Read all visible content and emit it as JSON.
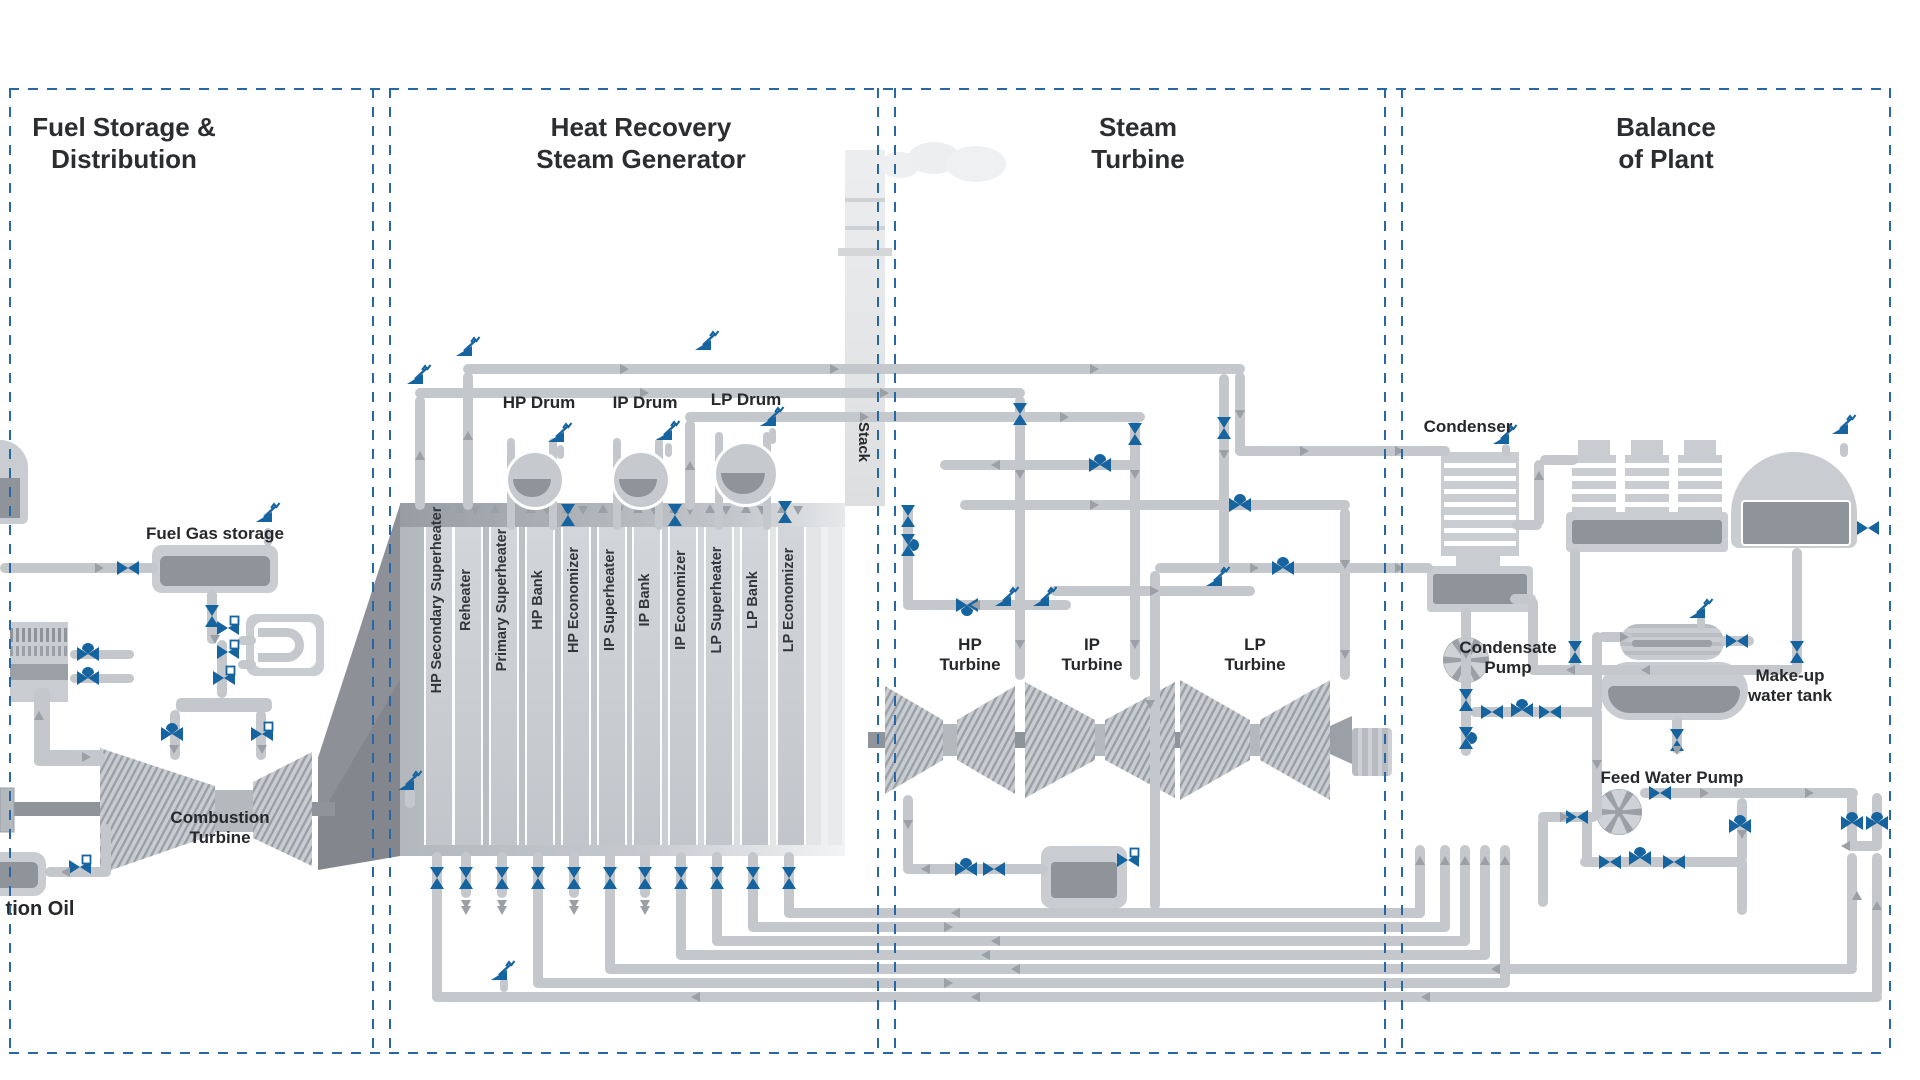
{
  "sections": [
    {
      "name": "fuel-storage",
      "label": "Fuel Storage &\nDistribution"
    },
    {
      "name": "hrsg",
      "label": "Heat Recovery\nSteam Generator"
    },
    {
      "name": "steam-turbine",
      "label": "Steam\nTurbine"
    },
    {
      "name": "balance-of-plant",
      "label": "Balance\nof Plant"
    }
  ],
  "colors": {
    "valve_blue": "#15639f",
    "dash_blue": "#2767a5",
    "pipe_gray": "#c4c8cc",
    "arrow_gray": "#9aa0a6",
    "equip_light": "#c9cdd2",
    "equip_dark": "#8f949a",
    "ink": "#2b2d31"
  },
  "borders": {
    "verticals": [
      9,
      372,
      389,
      877,
      894,
      1384,
      1401,
      1889
    ],
    "top": 88,
    "bottom": 1052
  },
  "hrsg_columns": [
    {
      "label": "HP Secondary Superheater",
      "x": 437,
      "run": 997
    },
    {
      "label": "Reheater",
      "x": 466
    },
    {
      "label": "Primary Superheater",
      "x": 502
    },
    {
      "label": "HP Bank",
      "x": 538,
      "run": 983
    },
    {
      "label": "HP Economizer",
      "x": 574
    },
    {
      "label": "IP Superheater",
      "x": 610,
      "run": 969
    },
    {
      "label": "IP Bank",
      "x": 645
    },
    {
      "label": "IP Economizer",
      "x": 681,
      "run": 955
    },
    {
      "label": "LP Superheater",
      "x": 717,
      "run": 941
    },
    {
      "label": "LP Bank",
      "x": 753,
      "run": 927
    },
    {
      "label": "LP Economizer",
      "x": 789,
      "run": 913
    }
  ],
  "drums": [
    {
      "name": "hp-drum",
      "x": 532,
      "y": 477,
      "r": 27
    },
    {
      "name": "ip-drum",
      "x": 638,
      "y": 477,
      "r": 27
    },
    {
      "name": "lp-drum",
      "x": 743,
      "y": 471,
      "r": 30
    }
  ],
  "labels": [
    {
      "name": "hp-drum-label",
      "text": "HP Drum",
      "x": 539,
      "y": 403
    },
    {
      "name": "ip-drum-label",
      "text": "IP Drum",
      "x": 645,
      "y": 403
    },
    {
      "name": "lp-drum-label",
      "text": "LP Drum",
      "x": 746,
      "y": 400
    },
    {
      "name": "stack-label",
      "text": "Stack",
      "x": 863,
      "y": 442,
      "rot": 90,
      "size": 15
    },
    {
      "name": "hp-turbine-label",
      "text": "HP\nTurbine",
      "x": 970,
      "y": 655
    },
    {
      "name": "ip-turbine-label",
      "text": "IP\nTurbine",
      "x": 1092,
      "y": 655
    },
    {
      "name": "lp-turbine-label",
      "text": "LP\nTurbine",
      "x": 1255,
      "y": 655
    },
    {
      "name": "combustion-turbine-label",
      "text": "Combustion\nTurbine",
      "x": 220,
      "y": 828
    },
    {
      "name": "fuel-gas-storage-label",
      "text": "Fuel Gas storage",
      "x": 215,
      "y": 534
    },
    {
      "name": "oil-label",
      "text": "tion Oil",
      "x": 40,
      "y": 910,
      "size": 20
    },
    {
      "name": "condenser-label",
      "text": "Condenser",
      "x": 1468,
      "y": 427
    },
    {
      "name": "condensate-pump-label",
      "text": "Condensate\nPump",
      "x": 1508,
      "y": 658
    },
    {
      "name": "makeup-water-tank-label",
      "text": "Make-up\nwater tank",
      "x": 1790,
      "y": 686
    },
    {
      "name": "feed-water-pump-label",
      "text": "Feed Water Pump",
      "x": 1672,
      "y": 778
    }
  ],
  "pipes": [
    [
      0,
      563,
      158,
      10
    ],
    [
      207,
      590,
      10,
      54
    ],
    [
      176,
      698,
      96,
      14
    ],
    [
      170,
      710,
      10,
      50
    ],
    [
      256,
      710,
      10,
      50
    ],
    [
      70,
      650,
      64,
      9
    ],
    [
      70,
      674,
      64,
      9
    ],
    [
      34,
      688,
      16,
      76
    ],
    [
      34,
      750,
      70,
      16
    ],
    [
      45,
      867,
      64,
      10
    ],
    [
      101,
      824,
      10,
      53
    ],
    [
      238,
      636,
      18,
      9
    ],
    [
      238,
      660,
      18,
      9
    ],
    [
      217,
      640,
      10,
      58
    ],
    [
      415,
      388,
      610,
      10
    ],
    [
      415,
      396,
      10,
      114
    ],
    [
      1015,
      396,
      10,
      284
    ],
    [
      463,
      364,
      782,
      10
    ],
    [
      463,
      372,
      10,
      138
    ],
    [
      1235,
      372,
      10,
      84
    ],
    [
      1235,
      446,
      215,
      10
    ],
    [
      685,
      412,
      460,
      10
    ],
    [
      685,
      420,
      10,
      90
    ],
    [
      1130,
      420,
      10,
      260
    ],
    [
      960,
      500,
      390,
      10
    ],
    [
      1340,
      508,
      10,
      172
    ],
    [
      940,
      460,
      200,
      10
    ],
    [
      903,
      505,
      10,
      102
    ],
    [
      903,
      600,
      168,
      10
    ],
    [
      1050,
      586,
      205,
      10
    ],
    [
      1219,
      374,
      10,
      196
    ],
    [
      1155,
      563,
      278,
      10
    ],
    [
      1150,
      571,
      10,
      339
    ],
    [
      507,
      438,
      8,
      92
    ],
    [
      549,
      438,
      8,
      92
    ],
    [
      613,
      438,
      8,
      92
    ],
    [
      655,
      438,
      8,
      92
    ],
    [
      715,
      432,
      8,
      98
    ],
    [
      763,
      432,
      8,
      98
    ],
    [
      557,
      445,
      7,
      14
    ],
    [
      665,
      443,
      7,
      14
    ],
    [
      769,
      428,
      7,
      16
    ],
    [
      405,
      788,
      10,
      20
    ],
    [
      903,
      795,
      10,
      76
    ],
    [
      903,
      864,
      145,
      10
    ],
    [
      1512,
      520,
      30,
      10
    ],
    [
      1534,
      460,
      10,
      66
    ],
    [
      1540,
      455,
      38,
      10
    ],
    [
      1570,
      548,
      10,
      124
    ],
    [
      1792,
      548,
      10,
      124
    ],
    [
      1528,
      598,
      10,
      74
    ],
    [
      1510,
      594,
      26,
      10
    ],
    [
      1528,
      665,
      274,
      10
    ],
    [
      1461,
      608,
      10,
      148
    ],
    [
      1470,
      707,
      130,
      10
    ],
    [
      1592,
      632,
      10,
      80
    ],
    [
      1598,
      632,
      34,
      10
    ],
    [
      1592,
      707,
      10,
      112
    ],
    [
      1538,
      812,
      60,
      10
    ],
    [
      1538,
      817,
      10,
      90
    ],
    [
      1720,
      636,
      34,
      10
    ],
    [
      1672,
      716,
      10,
      38
    ],
    [
      1640,
      788,
      218,
      10
    ],
    [
      1737,
      798,
      10,
      64
    ],
    [
      1582,
      817,
      10,
      44
    ],
    [
      1580,
      857,
      164,
      10
    ],
    [
      1737,
      857,
      10,
      58
    ],
    [
      1847,
      793,
      10,
      55
    ],
    [
      1872,
      793,
      10,
      55
    ],
    [
      1847,
      841,
      35,
      10
    ],
    [
      1847,
      853,
      10,
      116
    ],
    [
      1872,
      853,
      10,
      144
    ],
    [
      784,
      908,
      641,
      10
    ],
    [
      748,
      922,
      702,
      10
    ],
    [
      712,
      936,
      758,
      10
    ],
    [
      676,
      950,
      814,
      10
    ],
    [
      605,
      964,
      1252,
      10
    ],
    [
      534,
      978,
      976,
      10
    ],
    [
      432,
      992,
      1450,
      10
    ],
    [
      1415,
      845,
      10,
      73
    ],
    [
      1440,
      845,
      10,
      87
    ],
    [
      1460,
      845,
      10,
      101
    ],
    [
      1480,
      845,
      10,
      115
    ],
    [
      1500,
      845,
      10,
      143
    ],
    [
      264,
      528,
      8,
      18
    ],
    [
      1840,
      443,
      8,
      14
    ],
    [
      1697,
      616,
      8,
      14
    ],
    [
      1502,
      444,
      8,
      12
    ],
    [
      500,
      978,
      8,
      14
    ]
  ],
  "valves": [
    [
      "gate",
      128,
      568,
      0
    ],
    [
      "gate",
      994,
      869,
      0
    ],
    [
      "gate",
      1492,
      712,
      0
    ],
    [
      "gate",
      1550,
      712,
      0
    ],
    [
      "gate",
      1577,
      817,
      0
    ],
    [
      "gate",
      1660,
      793,
      0
    ],
    [
      "gate",
      1610,
      862,
      0
    ],
    [
      "gate",
      1674,
      862,
      0
    ],
    [
      "gate",
      1868,
      528,
      0
    ],
    [
      "gate",
      1737,
      641,
      0
    ],
    [
      "gate",
      212,
      616,
      90
    ],
    [
      "gate",
      568,
      515,
      90
    ],
    [
      "gate",
      675,
      515,
      90
    ],
    [
      "gate",
      785,
      512,
      90
    ],
    [
      "gate",
      908,
      516,
      90
    ],
    [
      "gate",
      1020,
      414,
      90
    ],
    [
      "gate",
      1135,
      434,
      90
    ],
    [
      "gate",
      1224,
      428,
      90
    ],
    [
      "gate",
      1466,
      700,
      90
    ],
    [
      "gate",
      1575,
      652,
      90
    ],
    [
      "gate",
      1797,
      652,
      90
    ],
    [
      "gate",
      1677,
      740,
      90
    ],
    [
      "globe",
      88,
      654,
      0
    ],
    [
      "globe",
      88,
      678,
      0
    ],
    [
      "globe",
      966,
      869,
      0
    ],
    [
      "globe",
      1100,
      465,
      0
    ],
    [
      "globe",
      1240,
      505,
      0
    ],
    [
      "globe",
      1522,
      710,
      0
    ],
    [
      "globe",
      1640,
      858,
      0
    ],
    [
      "globe",
      1740,
      826,
      0
    ],
    [
      "globe",
      1852,
      823,
      0
    ],
    [
      "globe",
      1877,
      823,
      0
    ],
    [
      "globe",
      967,
      605,
      180
    ],
    [
      "globe",
      908,
      545,
      90
    ],
    [
      "globe",
      1466,
      738,
      90
    ],
    [
      "globe",
      1283,
      568,
      0
    ],
    [
      "check",
      80,
      867,
      0
    ],
    [
      "check",
      228,
      628,
      0
    ],
    [
      "check",
      228,
      652,
      0
    ],
    [
      "check",
      224,
      678,
      0
    ],
    [
      "check",
      262,
      734,
      0
    ],
    [
      "check",
      1128,
      860,
      0
    ],
    [
      "globe",
      172,
      734,
      0
    ],
    [
      "relief",
      268,
      514,
      0
    ],
    [
      "relief",
      419,
      376,
      0
    ],
    [
      "relief",
      468,
      348,
      0
    ],
    [
      "relief",
      707,
      342,
      0
    ],
    [
      "relief",
      560,
      434,
      0
    ],
    [
      "relief",
      668,
      432,
      0
    ],
    [
      "relief",
      772,
      418,
      0
    ],
    [
      "relief",
      1007,
      598,
      0
    ],
    [
      "relief",
      1045,
      598,
      0
    ],
    [
      "relief",
      1218,
      578,
      0
    ],
    [
      "relief",
      503,
      972,
      0
    ],
    [
      "relief",
      410,
      782,
      0
    ],
    [
      "relief",
      1505,
      436,
      0
    ],
    [
      "relief",
      1701,
      610,
      0
    ],
    [
      "relief",
      1844,
      426,
      0
    ]
  ],
  "arrows": [
    [
      "r",
      95,
      568
    ],
    [
      "r",
      620,
      369
    ],
    [
      "r",
      830,
      369
    ],
    [
      "r",
      1090,
      369
    ],
    [
      "r",
      640,
      393
    ],
    [
      "r",
      880,
      393
    ],
    [
      "r",
      860,
      417
    ],
    [
      "r",
      1060,
      417
    ],
    [
      "r",
      1090,
      505
    ],
    [
      "r",
      1300,
      451
    ],
    [
      "r",
      1395,
      451
    ],
    [
      "r",
      1250,
      568
    ],
    [
      "r",
      1395,
      568
    ],
    [
      "r",
      82,
      757
    ],
    [
      "r",
      1150,
      591
    ],
    [
      "r",
      1620,
      637
    ],
    [
      "r",
      1700,
      793
    ],
    [
      "r",
      1805,
      793
    ],
    [
      "r",
      1560,
      817
    ],
    [
      "r",
      944,
      927
    ],
    [
      "r",
      944,
      983
    ],
    [
      "l",
      70,
      872
    ],
    [
      "l",
      930,
      869
    ],
    [
      "l",
      980,
      605
    ],
    [
      "l",
      1000,
      465
    ],
    [
      "l",
      1650,
      670
    ],
    [
      "l",
      1575,
      670
    ],
    [
      "l",
      1850,
      846
    ],
    [
      "l",
      960,
      913
    ],
    [
      "l",
      1000,
      941
    ],
    [
      "l",
      990,
      955
    ],
    [
      "l",
      1020,
      969
    ],
    [
      "l",
      1500,
      969
    ],
    [
      "l",
      980,
      997
    ],
    [
      "l",
      1430,
      997
    ],
    [
      "l",
      700,
      997
    ],
    [
      "u",
      420,
      460
    ],
    [
      "u",
      468,
      440
    ],
    [
      "u",
      690,
      470
    ],
    [
      "u",
      1539,
      480
    ],
    [
      "u",
      1420,
      865
    ],
    [
      "u",
      1445,
      865
    ],
    [
      "u",
      1465,
      865
    ],
    [
      "u",
      1485,
      865
    ],
    [
      "u",
      1505,
      865
    ],
    [
      "u",
      39,
      720
    ],
    [
      "u",
      1857,
      900
    ],
    [
      "u",
      1877,
      910
    ],
    [
      "d",
      1020,
      470
    ],
    [
      "d",
      1020,
      640
    ],
    [
      "d",
      1135,
      470
    ],
    [
      "d",
      1135,
      640
    ],
    [
      "d",
      1240,
      410
    ],
    [
      "d",
      1345,
      560
    ],
    [
      "d",
      1345,
      650
    ],
    [
      "d",
      466,
      906
    ],
    [
      "d",
      502,
      906
    ],
    [
      "d",
      574,
      906
    ],
    [
      "d",
      645,
      906
    ],
    [
      "d",
      1466,
      650
    ],
    [
      "d",
      1597,
      760
    ],
    [
      "d",
      1677,
      746
    ],
    [
      "d",
      1742,
      830
    ],
    [
      "d",
      174,
      745
    ],
    [
      "d",
      262,
      745
    ],
    [
      "d",
      215,
      635
    ],
    [
      "d",
      908,
      820
    ],
    [
      "d",
      1150,
      700
    ],
    [
      "d",
      1224,
      450
    ]
  ]
}
